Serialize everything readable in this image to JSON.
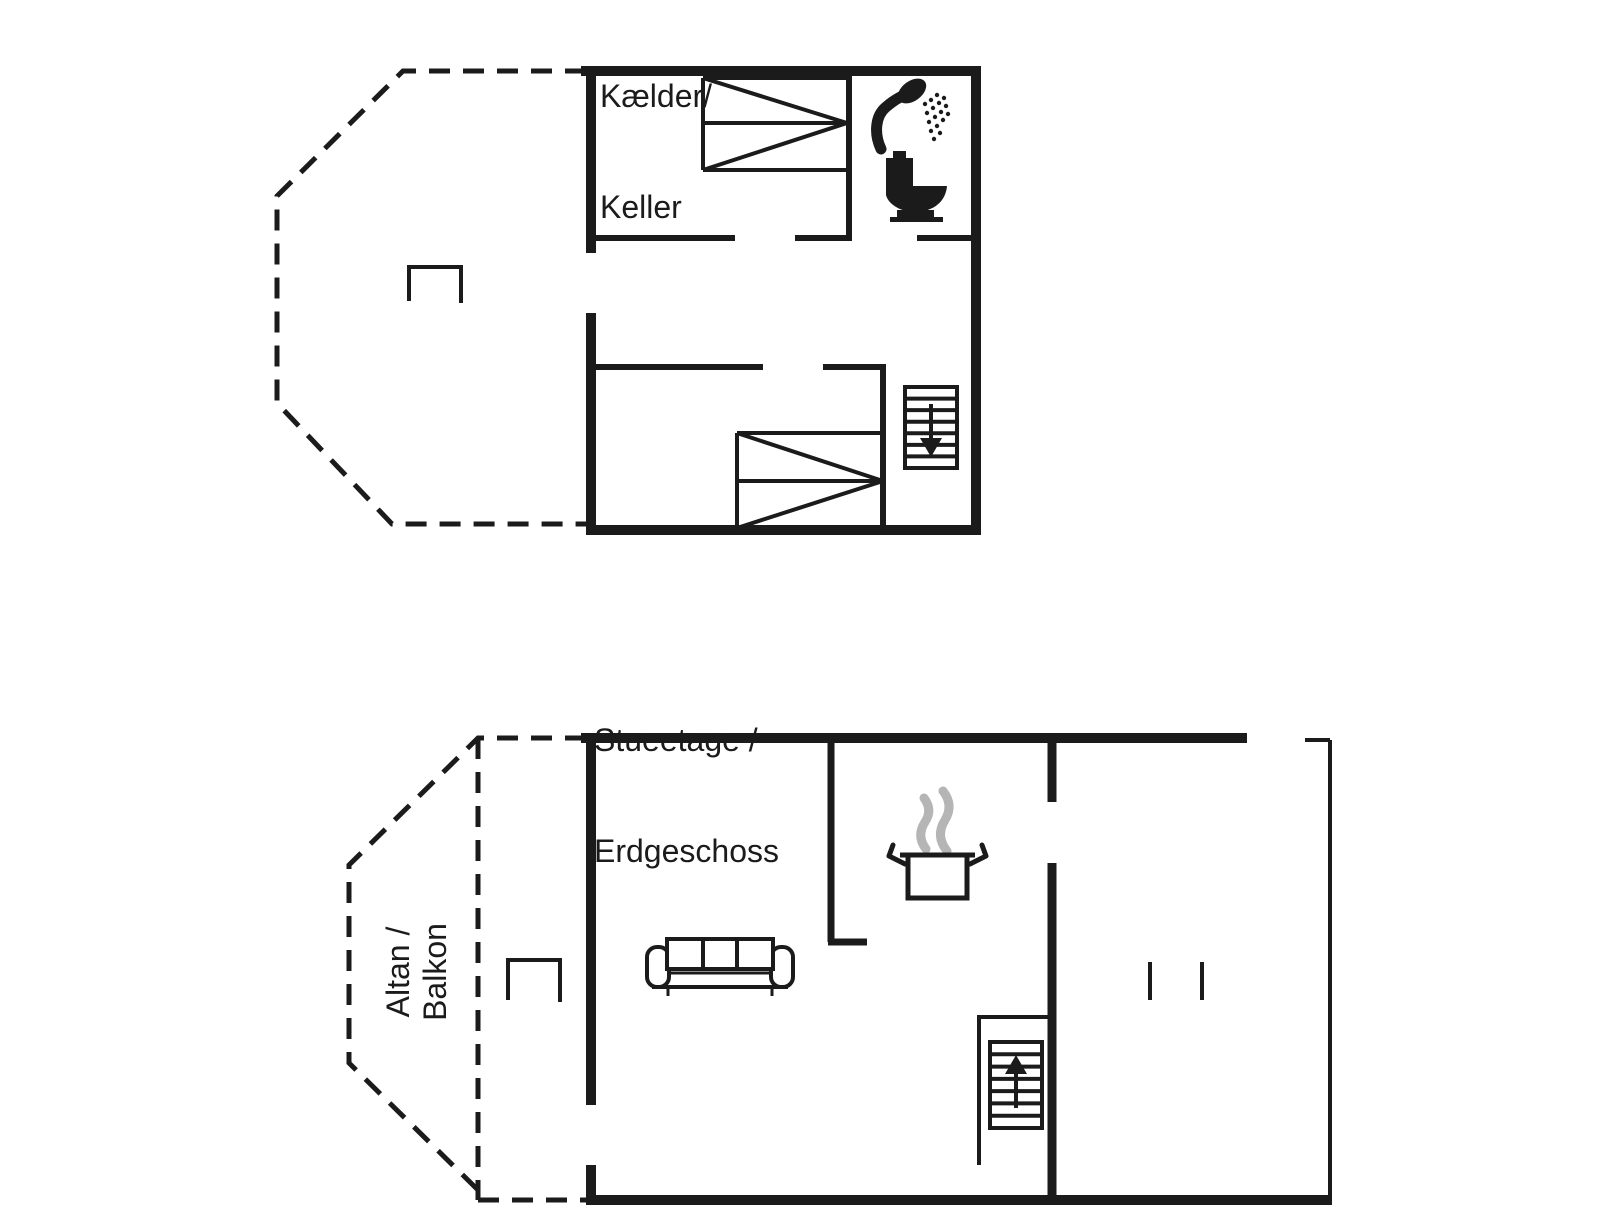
{
  "canvas": {
    "width": 1606,
    "height": 1205,
    "background": "#ffffff",
    "ink": "#1b1b1b",
    "steam_color": "#b5b5b5"
  },
  "floors": {
    "basement": {
      "title_line1": "Kælder/",
      "title_line2": "Keller"
    },
    "ground": {
      "title_line1": "Stueetage /",
      "title_line2": "Erdgeschoss"
    },
    "balcony": {
      "label_line1": "Altan /",
      "label_line2": "Balkon"
    }
  },
  "icons": {
    "shower": "shower-icon",
    "toilet": "toilet-icon",
    "stairs_down": "stairs-down-icon",
    "stairs_up": "stairs-up-icon",
    "cooking_pot": "cooking-pot-icon",
    "steam": "steam-icon",
    "sofa": "sofa-symbol",
    "double_bed": "double-bed-symbol",
    "wardrobe_marks": "wardrobe-marks",
    "table": "table-symbol"
  }
}
